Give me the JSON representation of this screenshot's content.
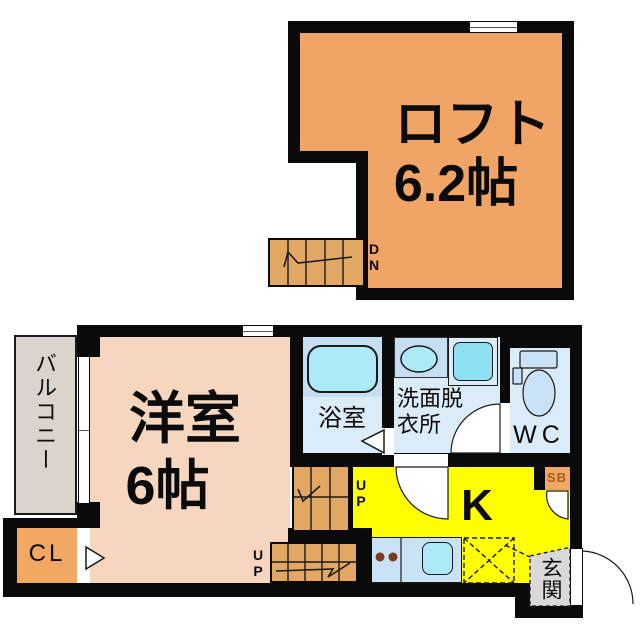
{
  "plan_title": "apartment floor plan",
  "loft": {
    "room_label": "ロフト",
    "room_size": "6.2帖",
    "stairs_label": "DN"
  },
  "first_floor": {
    "western_room": {
      "label": "洋室",
      "size": "6帖"
    },
    "balcony": {
      "label": "バルコニー"
    },
    "closet": {
      "label": "CL"
    },
    "bathroom": {
      "label": "浴室"
    },
    "washroom": {
      "label": "洗面脱衣所"
    },
    "toilet": {
      "label": "WC"
    },
    "kitchen": {
      "label": "K"
    },
    "shoe_box": {
      "label": "SB"
    },
    "entrance": {
      "label": "玄関"
    },
    "stairs_up_room_label": "UP",
    "stairs_up_kitchen_label": "UP"
  },
  "colors": {
    "wall": "#0a0a0a",
    "loft": "#f0a466",
    "stairs": "#e2a763",
    "room": "#f6d6be",
    "closet": "#f2a763",
    "blue-room": "#dcebf8",
    "blue-dark": "#c6def2",
    "cyan": "#aee9f6",
    "cyan-bright": "#8fe0f2",
    "yellow": "#ffff00",
    "counter": "#c9e2f5",
    "balcony": "#dbd4cd",
    "entrance": "#d9d9d9",
    "burner": "#7a3a1d",
    "sb-text": "#a85a28"
  }
}
